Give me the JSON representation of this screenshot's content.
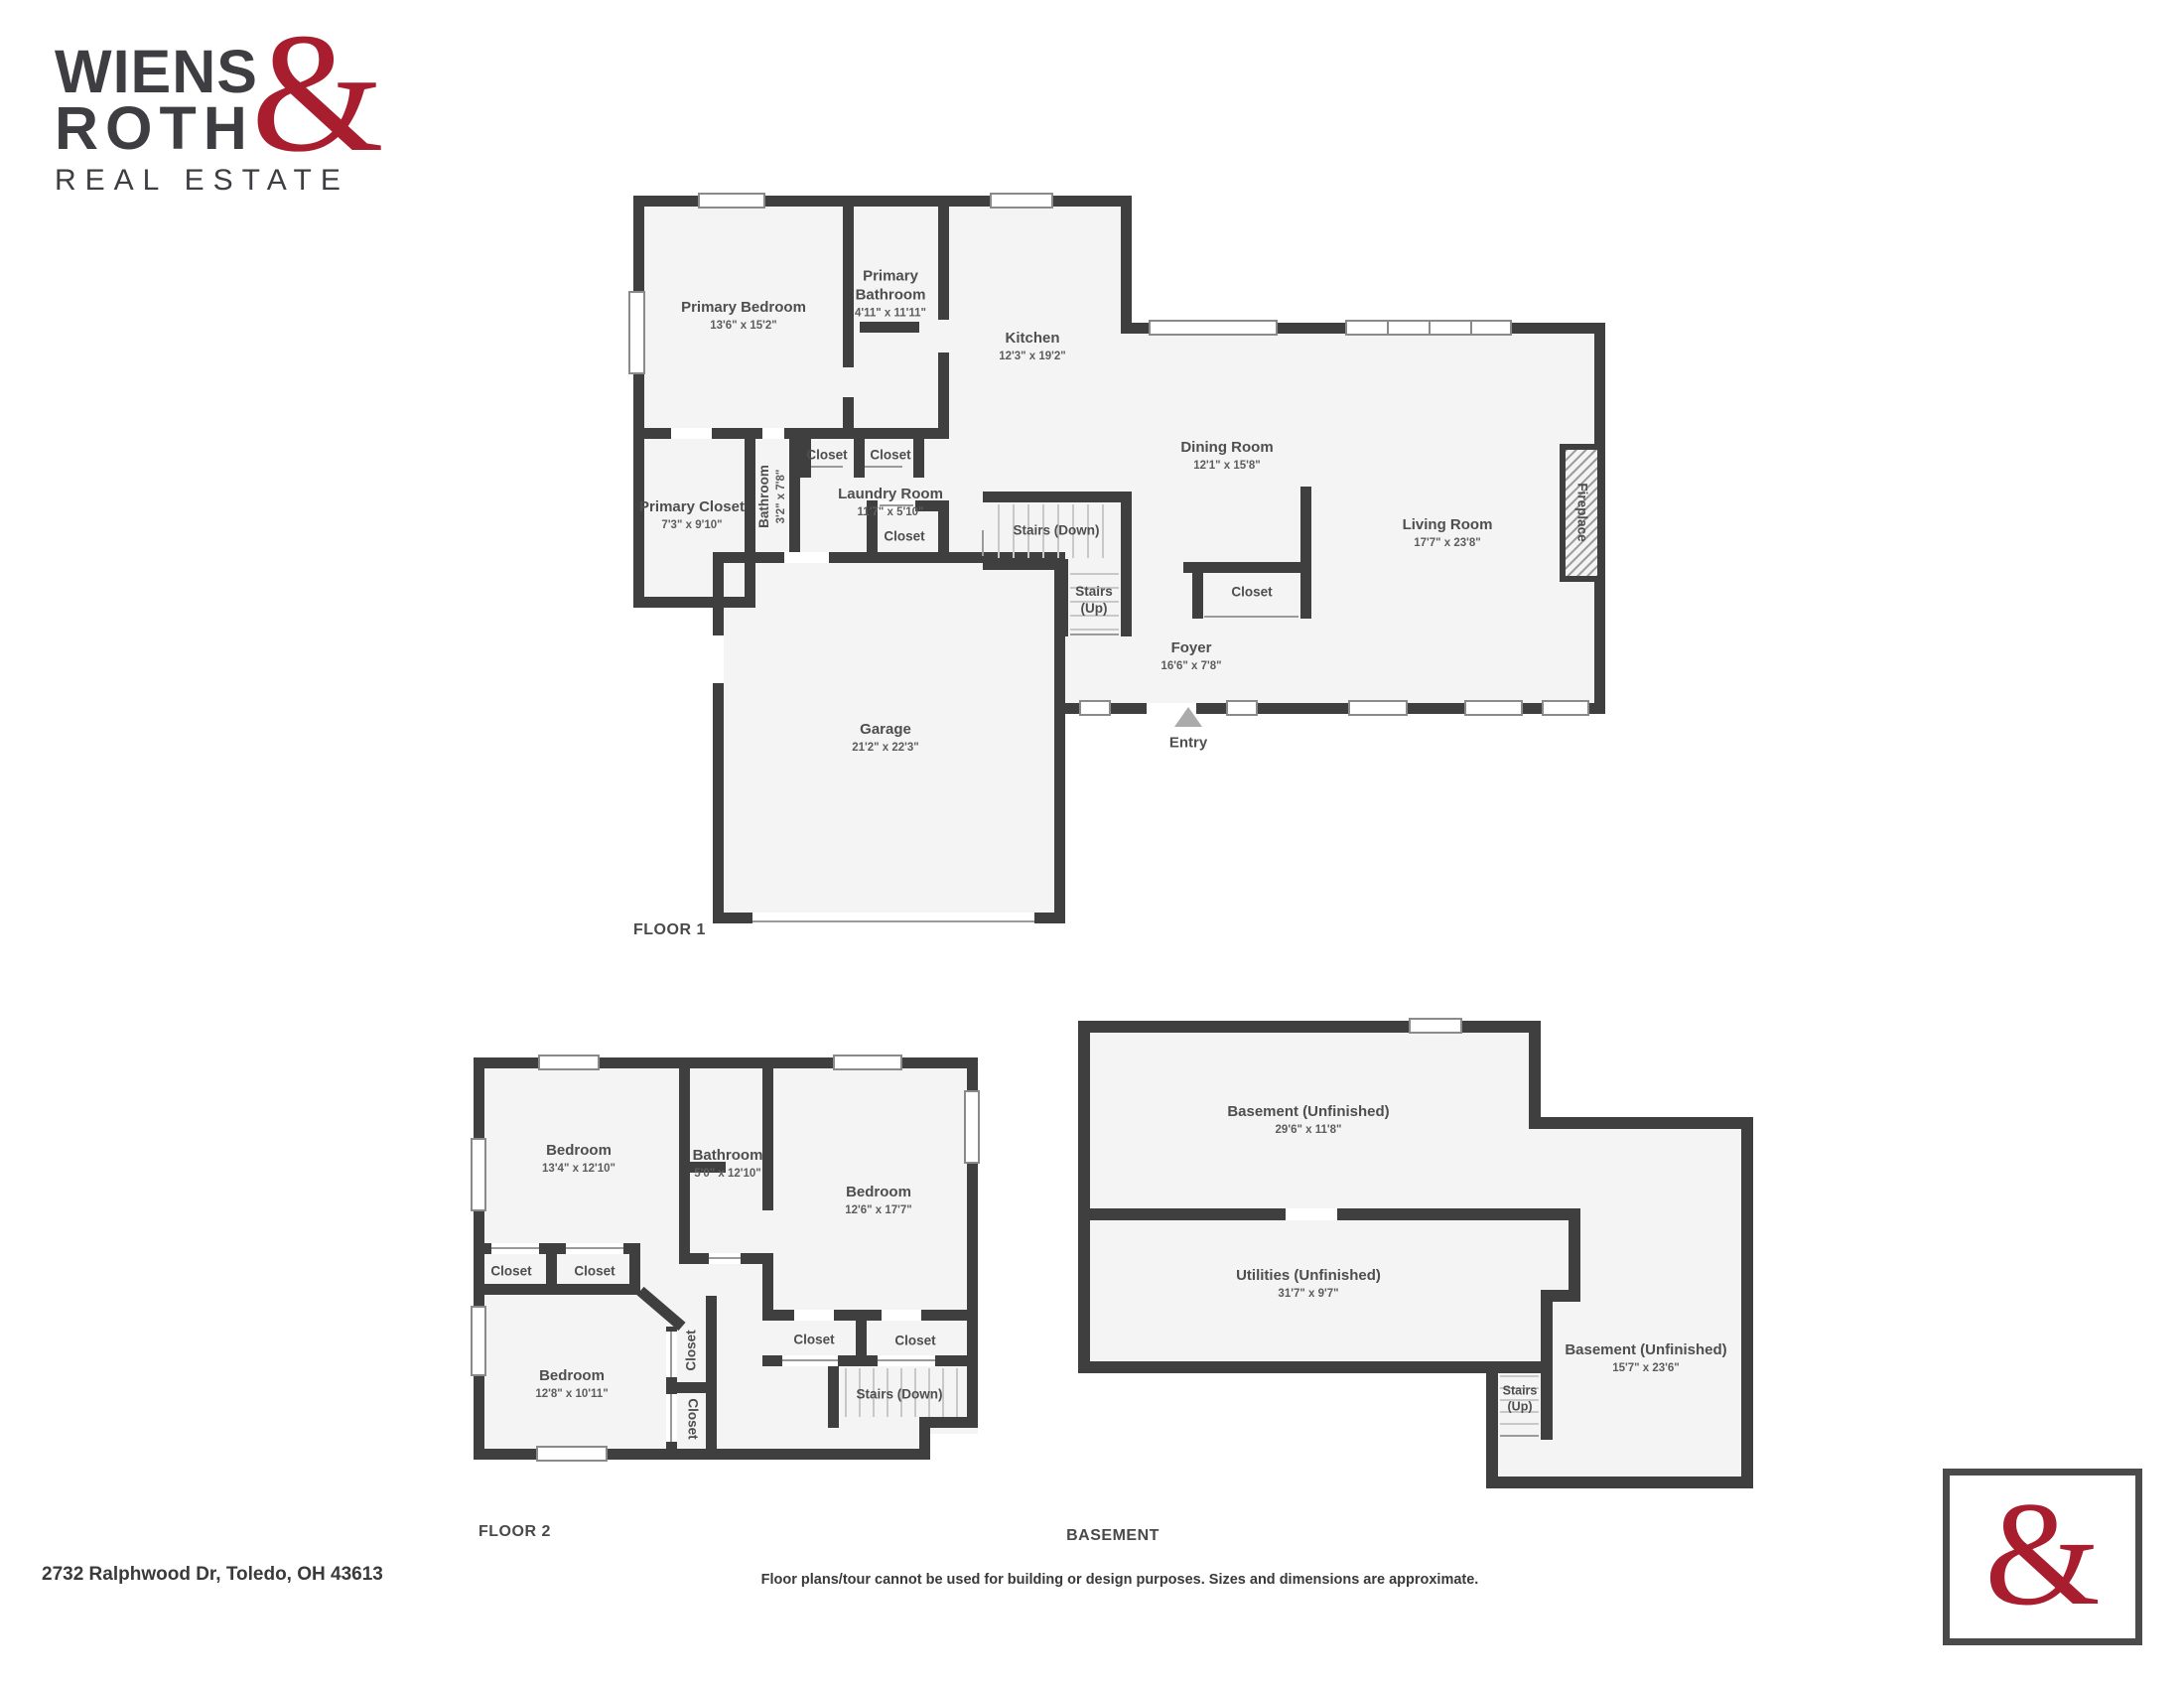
{
  "brand": {
    "line1": "WIENS",
    "line2": "ROTH",
    "amp": "&",
    "tagline": "REAL ESTATE"
  },
  "colors": {
    "wall": "#3f3f3f",
    "room_fill": "#f4f4f4",
    "accent_red": "#a81e2e",
    "label_gray": "#4e4e4e"
  },
  "floor1": {
    "title": "FLOOR 1",
    "rooms": {
      "primary_bedroom": {
        "name": "Primary Bedroom",
        "dims": "13'6\" x 15'2\""
      },
      "primary_bathroom": {
        "name": "Primary Bathroom",
        "dims": "4'11\" x 11'11\""
      },
      "kitchen": {
        "name": "Kitchen",
        "dims": "12'3\" x 19'2\""
      },
      "dining_room": {
        "name": "Dining Room",
        "dims": "12'1\" x 15'8\""
      },
      "living_room": {
        "name": "Living Room",
        "dims": "17'7\" x 23'8\""
      },
      "fireplace": {
        "name": "Fireplace"
      },
      "primary_closet": {
        "name": "Primary Closet",
        "dims": "7'3\" x 9'10\""
      },
      "bathroom": {
        "name": "Bathroom",
        "dims": "3'2\" x 7'8\""
      },
      "laundry_room": {
        "name": "Laundry Room",
        "dims": "11'7\" x 5'10\""
      },
      "closet_top_left": {
        "name": "Closet"
      },
      "closet_top_right": {
        "name": "Closet"
      },
      "closet_laundry": {
        "name": "Closet"
      },
      "stairs_down": {
        "name": "Stairs (Down)"
      },
      "stairs_up": {
        "line1": "Stairs",
        "line2": "(Up)"
      },
      "closet_foyer": {
        "name": "Closet"
      },
      "foyer": {
        "name": "Foyer",
        "dims": "16'6\" x 7'8\""
      },
      "garage": {
        "name": "Garage",
        "dims": "21'2\" x 22'3\""
      },
      "entry": {
        "name": "Entry"
      }
    }
  },
  "floor2": {
    "title": "FLOOR 2",
    "rooms": {
      "bedroom_1": {
        "name": "Bedroom",
        "dims": "13'4\" x 12'10\""
      },
      "bathroom": {
        "name": "Bathroom",
        "dims": "5'0\" x 12'10\""
      },
      "bedroom_2": {
        "name": "Bedroom",
        "dims": "12'6\" x 17'7\""
      },
      "closet_a": {
        "name": "Closet"
      },
      "closet_b": {
        "name": "Closet"
      },
      "bedroom_3": {
        "name": "Bedroom",
        "dims": "12'8\" x 10'11\""
      },
      "closet_v1": {
        "name": "Closet"
      },
      "closet_v2": {
        "name": "Closet"
      },
      "closet_c": {
        "name": "Closet"
      },
      "closet_d": {
        "name": "Closet"
      },
      "stairs_down": {
        "name": "Stairs (Down)"
      }
    }
  },
  "basement": {
    "title": "BASEMENT",
    "rooms": {
      "basement_main": {
        "name": "Basement (Unfinished)",
        "dims": "29'6\" x 11'8\""
      },
      "utilities": {
        "name": "Utilities (Unfinished)",
        "dims": "31'7\" x 9'7\""
      },
      "basement_right": {
        "name": "Basement (Unfinished)",
        "dims": "15'7\" x 23'6\""
      },
      "stairs_up": {
        "line1": "Stairs",
        "line2": "(Up)"
      }
    }
  },
  "footer": {
    "address": "2732 Ralphwood Dr, Toledo, OH 43613",
    "disclaimer": "Floor plans/tour cannot be used for building or design purposes. Sizes and dimensions are approximate."
  }
}
